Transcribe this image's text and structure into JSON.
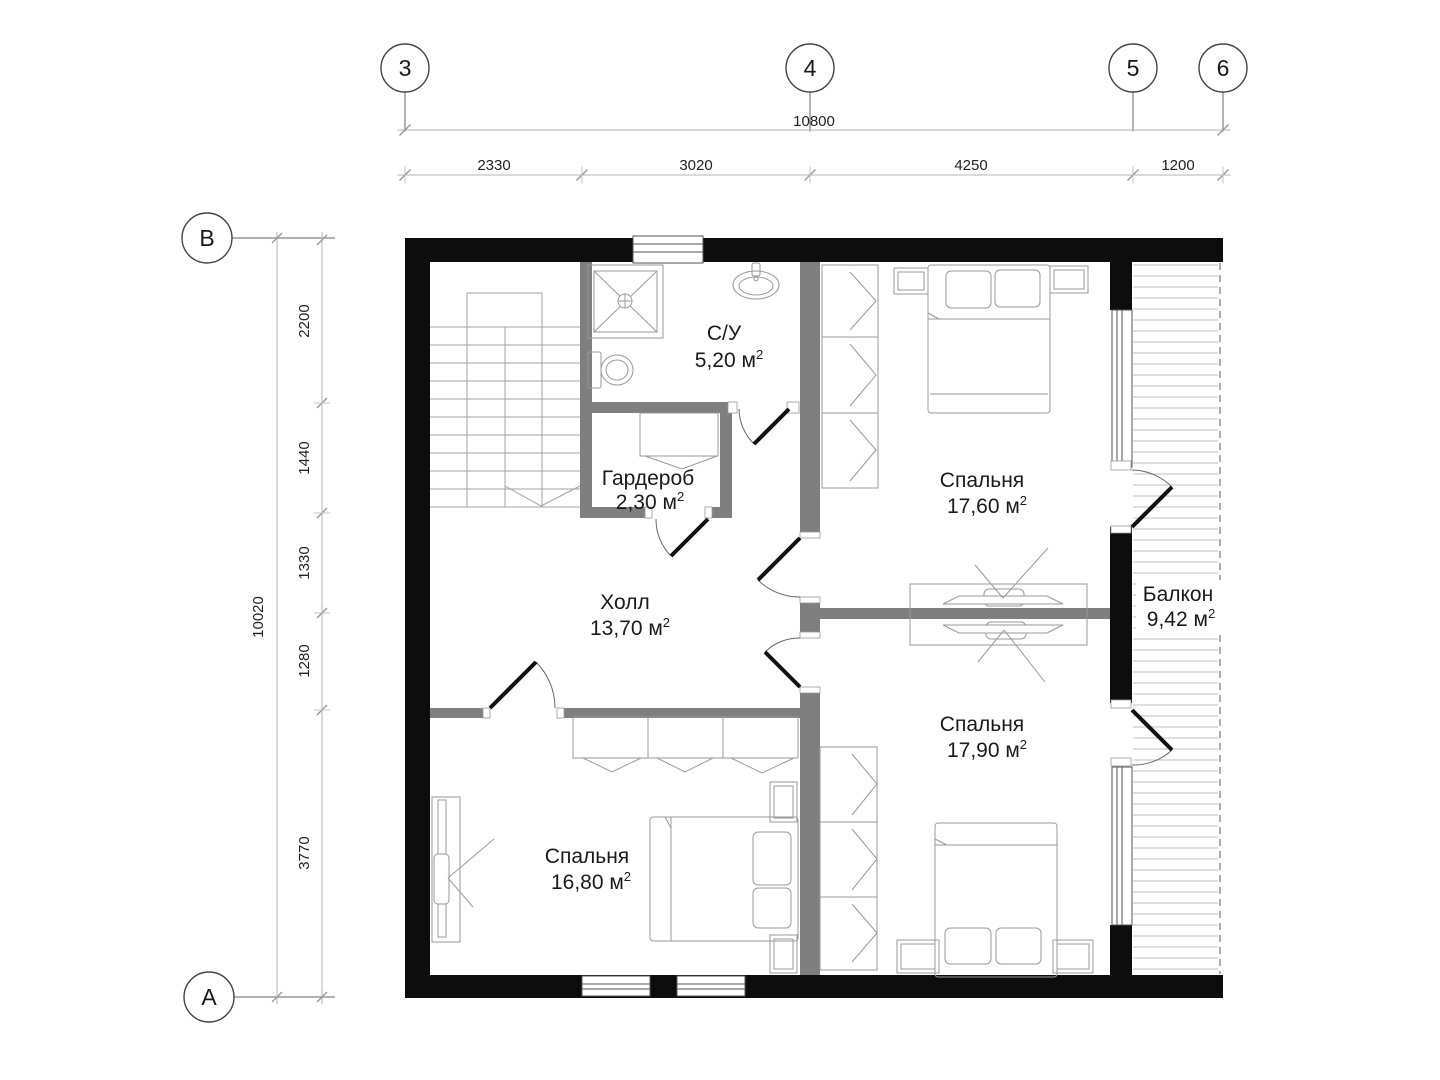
{
  "meta": {
    "sup": "2",
    "wall_color": "#0d0d0d",
    "partition_color": "#7f7f7f"
  },
  "axes": {
    "top": [
      {
        "label": "3"
      },
      {
        "label": "4"
      },
      {
        "label": "5"
      },
      {
        "label": "6"
      }
    ],
    "left": [
      {
        "label": "В"
      },
      {
        "label": "А"
      }
    ]
  },
  "dimensions": {
    "top_total": "10800",
    "top_segments": [
      "2330",
      "3020",
      "4250",
      "1200"
    ],
    "left_total": "10020",
    "left_segments": [
      "2200",
      "1440",
      "1330",
      "1280",
      "3770"
    ]
  },
  "rooms": [
    {
      "id": "bathroom",
      "name": "С/У",
      "area": "5,20 м"
    },
    {
      "id": "wardrobe",
      "name": "Гардероб",
      "area": "2,30 м"
    },
    {
      "id": "hall",
      "name": "Холл",
      "area": "13,70 м"
    },
    {
      "id": "bedroom-1",
      "name": "Спальня",
      "area": "17,60 м"
    },
    {
      "id": "bedroom-2",
      "name": "Спальня",
      "area": "17,90 м"
    },
    {
      "id": "bedroom-3",
      "name": "Спальня",
      "area": "16,80 м"
    },
    {
      "id": "balcony",
      "name": "Балкон",
      "area": "9,42 м"
    }
  ]
}
